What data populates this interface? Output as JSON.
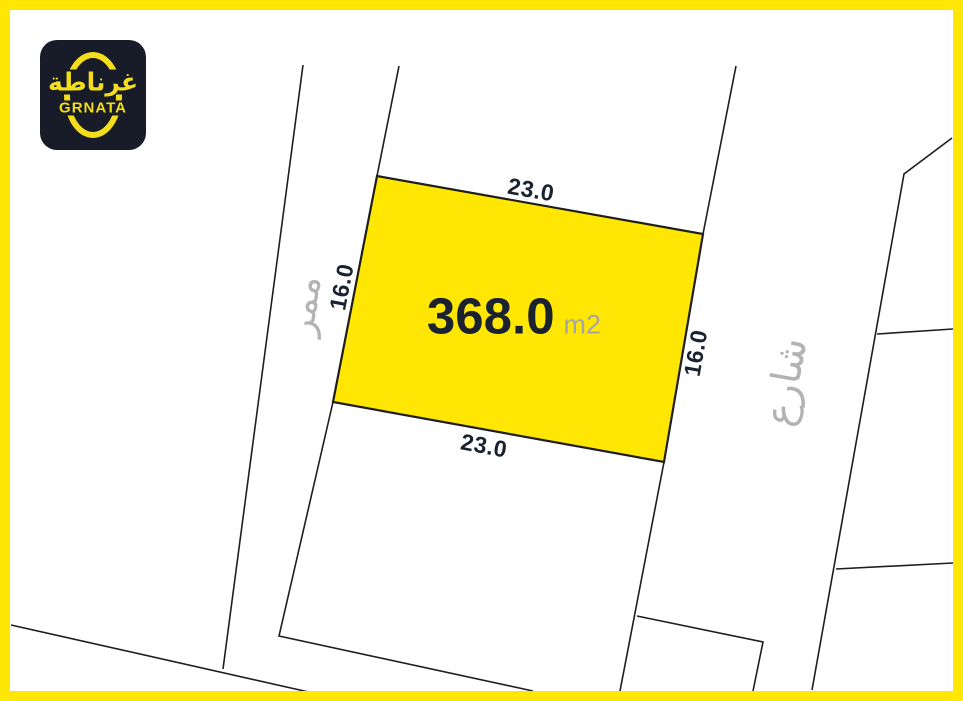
{
  "brand": {
    "logo_arabic": "غرناطة",
    "logo_latin": "GRNATA"
  },
  "plot": {
    "area_value": "368.0",
    "area_unit": "m2",
    "dimensions": {
      "top": "23.0",
      "bottom": "23.0",
      "left": "16.0",
      "right": "16.0"
    }
  },
  "labels": {
    "passage": "ممر",
    "street": "شارع"
  },
  "colors": {
    "frame_yellow": "#ffe603",
    "plot_fill": "#ffe603",
    "logo_background": "#171c28",
    "logo_yellow": "#f4de1c",
    "dimension_text": "#1a2230",
    "muted_gray": "#b3b3b3",
    "boundary_line": "#1e1e1e"
  }
}
